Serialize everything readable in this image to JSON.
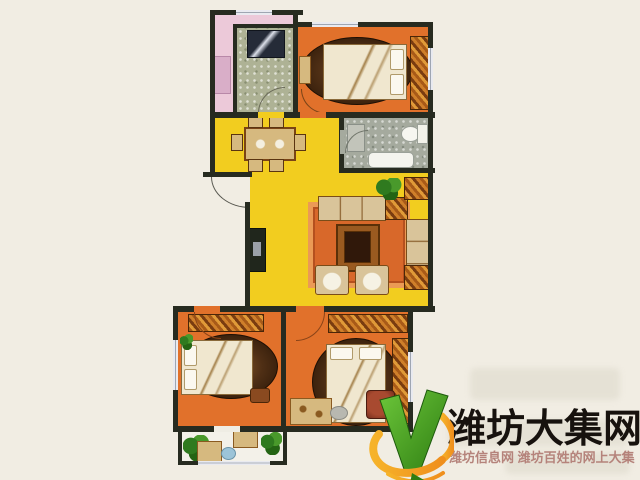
{
  "branding": {
    "site_name": "潍坊大集网",
    "tagline": "潍坊信息网 潍坊百姓的网上大集",
    "logo_icon": "green-v-check-with-orange-swoosh"
  },
  "floor_plan": {
    "type": "apartment-floor-plan",
    "rooms": [
      "north-utility-pink",
      "kitchen",
      "master-bedroom",
      "bathroom",
      "dining-area",
      "living-room",
      "second-bedroom",
      "third-bedroom",
      "south-balcony"
    ]
  },
  "colors": {
    "background": "#f1ede3",
    "wall": "#272b20",
    "bedroom_orange": "#e1712b",
    "living_yellow": "#f2cd1f",
    "utility_pink": "#ecc9d9",
    "kitchen_tile": "#aeb295",
    "bathroom_tile": "#a5aa9e",
    "balcony_white": "#f3f1e9",
    "rug_brown": "#4f2f15",
    "rug_orange": "#d8682a",
    "bed_linen": "#f0e7cf",
    "furniture_tan": "#d6b97f",
    "sofa_tan": "#d9c49a",
    "table_brown": "#7a4415",
    "window_glass": "#e9eaf0",
    "logo_green_dark": "#2e7d12",
    "logo_green": "#6cc63a",
    "logo_orange": "#ef8f1d",
    "logo_orange_light": "#f6b32a",
    "logo_text_color": "#17120e",
    "tagline_color": "#b5837b"
  }
}
